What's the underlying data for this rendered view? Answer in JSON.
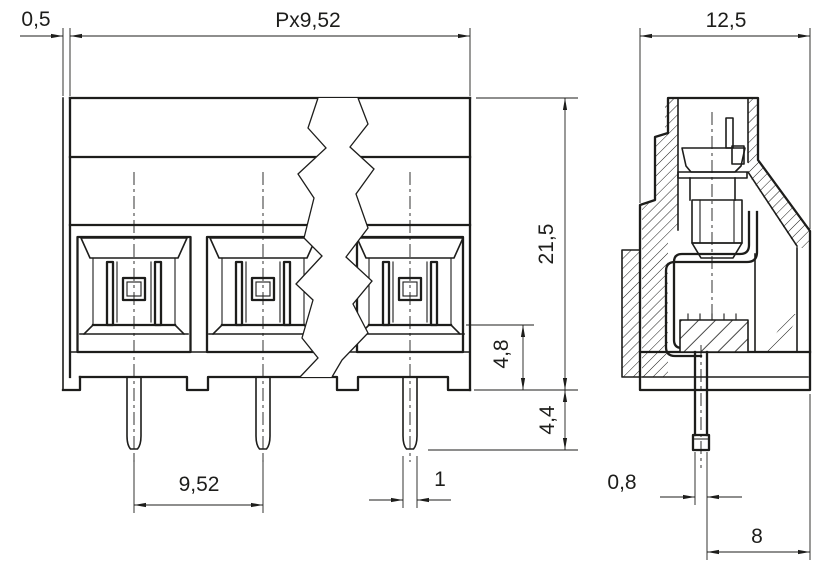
{
  "drawing": {
    "type": "technical-dimension-drawing",
    "subject": "pcb-screw-terminal-block",
    "unit_style": "comma-decimal",
    "background": "#ffffff",
    "line_color": "#1d1d1b",
    "views": {
      "front": "front-view-with-break",
      "side": "side-section-view"
    },
    "labels": {
      "flange_offset": "0,5",
      "total_pitch": "Px9,52",
      "side_width": "12,5",
      "housing_height": "21,5",
      "base_height": "4,8",
      "pin_protrusion": "4,4",
      "pin_pitch": "9,52",
      "pin_width": "1",
      "pin_thickness": "0,8",
      "pin_to_edge": "8"
    }
  }
}
